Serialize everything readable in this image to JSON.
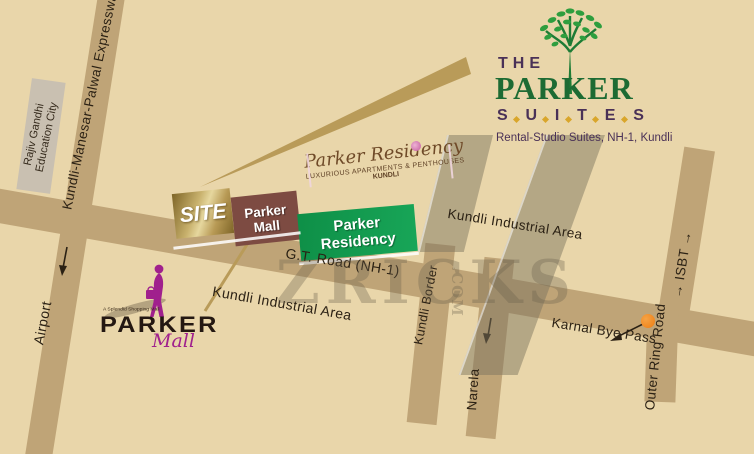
{
  "suites_logo": {
    "the": "THE",
    "parker": "PARKER",
    "suites_letters": [
      "S",
      "U",
      "I",
      "T",
      "E",
      "S"
    ],
    "tagline": "Rental-Studio Suites, NH-1, Kundli"
  },
  "residency_logo": {
    "name": "Parker Residency",
    "subtitle": "LUXURIOUS APARTMENTS & PENTHOUSES",
    "city": "KUNDLI"
  },
  "mall_logo": {
    "tagline": "A Splendid Shopping Mall",
    "name": "PARKER",
    "sub": "Mall"
  },
  "boxes": {
    "site": "SITE",
    "mall_line1": "Parker",
    "mall_line2": "Mall",
    "residency_line1": "Parker",
    "residency_line2": "Residency"
  },
  "labels": {
    "expressway": "Kundli-Manesar-Palwal Expressway",
    "education_city_line1": "Rajiv Gandhi",
    "education_city_line2": "Education City",
    "airport": "Airport",
    "gt_road": "G.T. Road (NH-1)",
    "kundli_industrial_upper": "Kundli Industrial Area",
    "kundli_industrial_lower": "Kundli Industrial Area",
    "kundli_border": "Kundli Border",
    "narela": "Narela",
    "karnal_bye_pass": "Karnal Bye Pass",
    "outer_ring_road": "Outer Ring Road",
    "isbt": "→ ISBT →"
  },
  "watermark": {
    "text": "ZRICKS",
    "suffix": ".COM"
  },
  "colors": {
    "background": "#e9d6aa",
    "road": "#bfa477",
    "site_gold": "#b89a55",
    "mall_maroon": "#7d4b42",
    "residency_green": "#129a4f",
    "logo_purple": "#4a3157",
    "logo_green": "#1d6b33",
    "magenta": "#a0208d",
    "orange_dot": "#ee7d12",
    "script_brown": "#6f4a28"
  }
}
